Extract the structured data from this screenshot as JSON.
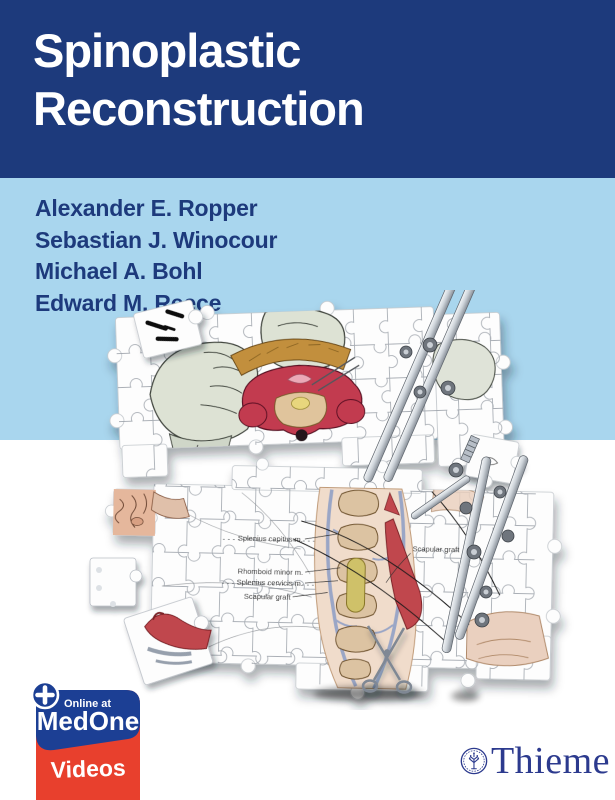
{
  "title": {
    "line1": "Spinoplastic",
    "line2": "Reconstruction"
  },
  "authors": [
    "Alexander E. Ropper",
    "Sebastian J. Winocour",
    "Michael A. Bohl",
    "Edward M. Reece"
  ],
  "illustration": {
    "description": "surgical anatomy illustration broken into jigsaw puzzle pieces",
    "labels": {
      "splenius_capitus": "Splenius capitus m.",
      "rhomboid_minor": "Rhomboid minor m.",
      "splenius_cervicis": "Splenius cervicis m.",
      "scapular_graft_left": "Scapular graft",
      "scapular_graft_right": "Scapular graft"
    }
  },
  "medone": {
    "online_at": "Online at",
    "brand": "MedOne",
    "product": "Videos"
  },
  "publisher": {
    "name": "Thieme"
  },
  "colors": {
    "navy_band": "#1d3a7c",
    "sky_band": "#a9d6ee",
    "medone_blue": "#1c3f94",
    "medone_red": "#e8402d",
    "thieme_blue": "#2c3a8e"
  }
}
